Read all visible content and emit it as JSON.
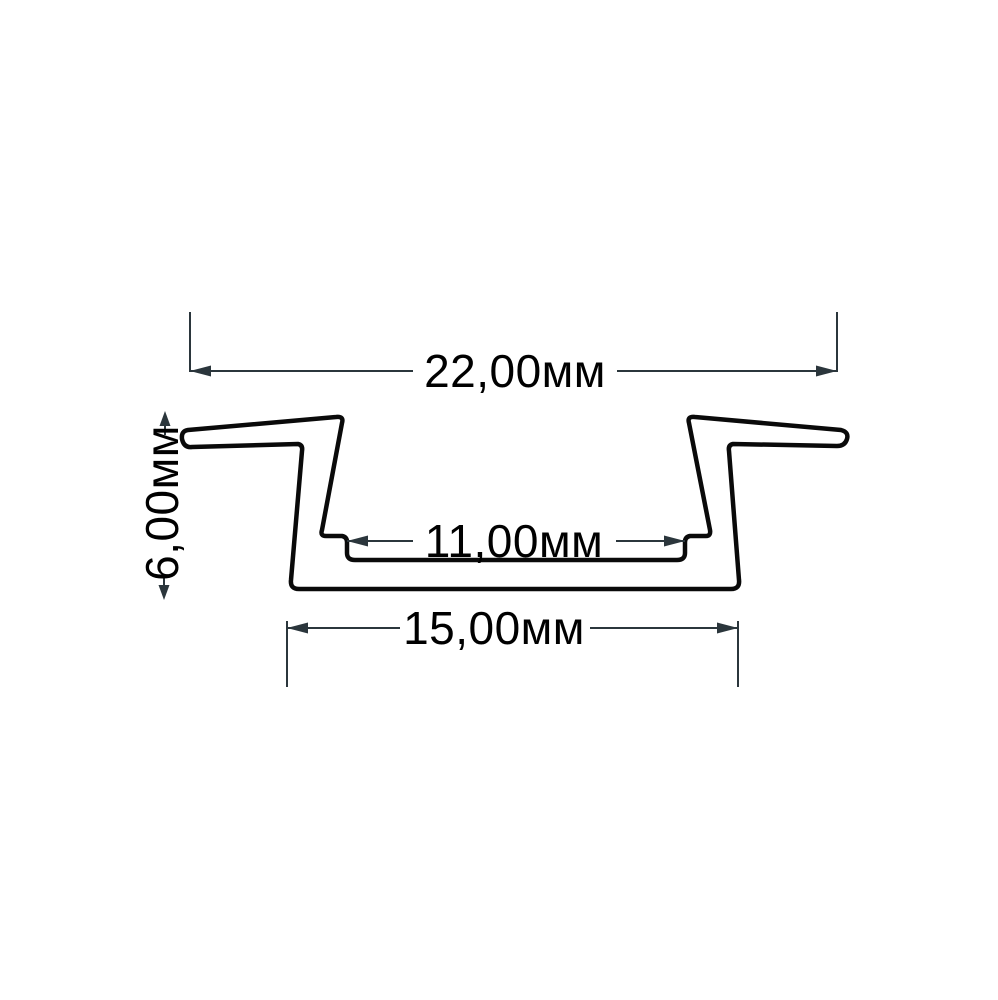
{
  "drawing": {
    "unit": "мм",
    "dimensions": {
      "overall_width": {
        "label": "22,00мм",
        "value_mm": 22.0
      },
      "height": {
        "label": "6,00мм",
        "value_mm": 6.0
      },
      "inner_width": {
        "label": "11,00мм",
        "value_mm": 11.0
      },
      "base_width": {
        "label": "15,00мм",
        "value_mm": 15.0
      }
    },
    "colors": {
      "background": "#ffffff",
      "profile_outline": "#0a0a0a",
      "dimension": "#2b363c",
      "label_text": "#000000"
    }
  }
}
